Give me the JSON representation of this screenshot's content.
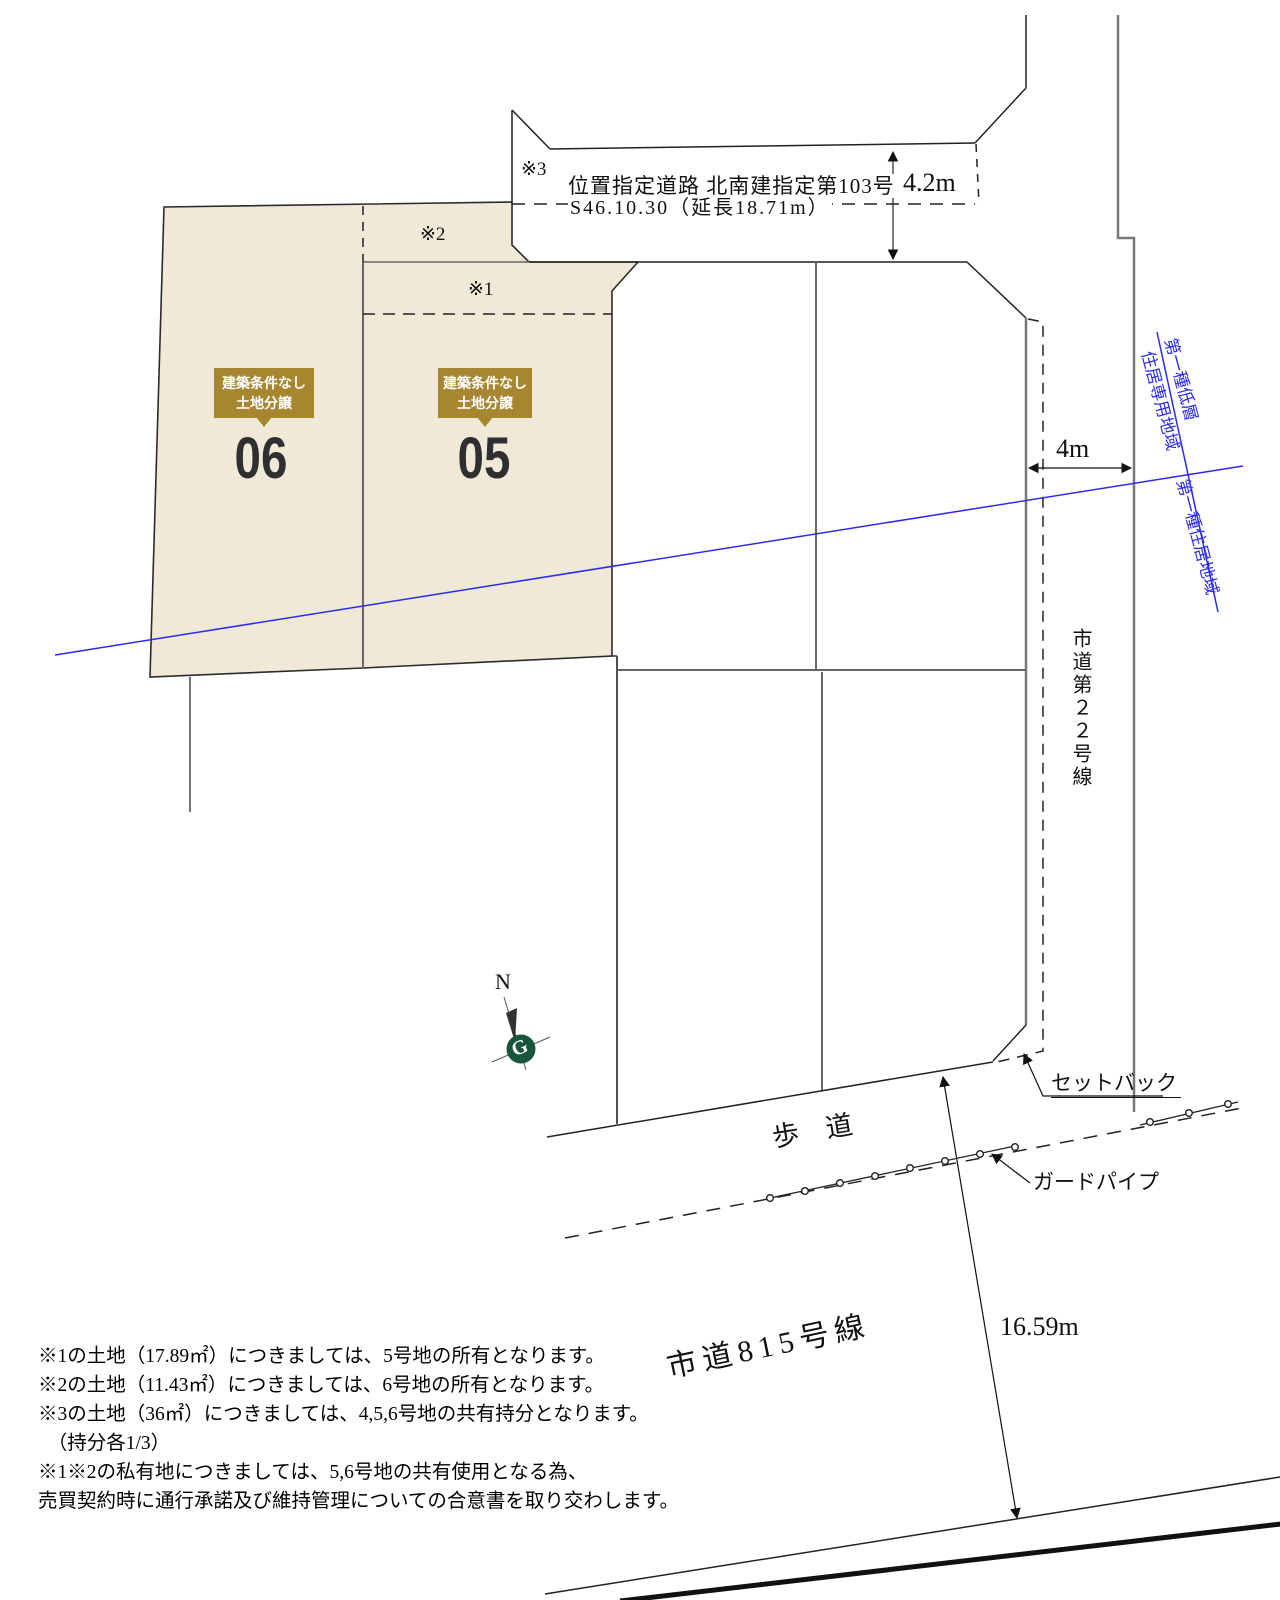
{
  "private_road": {
    "note3": "※3",
    "name": "位置指定道路 北南建指定第103号",
    "spec": "S46.10.30（延長18.71m）",
    "width_dim": "4.2m"
  },
  "lots": {
    "lot06": {
      "badge_line1": "建築条件なし",
      "badge_line2": "土地分譲",
      "number": "06"
    },
    "lot05": {
      "badge_line1": "建築条件なし",
      "badge_line2": "土地分譲",
      "number": "05"
    },
    "note1": "※1",
    "note2": "※2"
  },
  "city_road22": {
    "width_dim": "4m",
    "name_vertical": "市道第２２号線",
    "setback_label": "セットバック"
  },
  "zoning": {
    "upper_zone_line1": "第一種低層",
    "upper_zone_line2": "住居専用地域",
    "lower_zone": "第一種住居地域"
  },
  "south_area": {
    "sidewalk": "歩　道",
    "guard_pipe": "ガードパイプ",
    "frontage_dim": "16.59m",
    "road_name": "市道815号線"
  },
  "compass": {
    "north": "N",
    "logo": "G"
  },
  "notes": [
    "※1の土地（17.89㎡）につきましては、5号地の所有となります。",
    "※2の土地（11.43㎡）につきましては、6号地の所有となります。",
    "※3の土地（36㎡）につきましては、4,5,6号地の共有持分となります。",
    "　（持分各1/3）",
    "※1※2の私有地につきましては、5,6号地の共有使用となる為、",
    "売買契約時に通行承諾及び維持管理についての合意書を取り交わします。"
  ],
  "colors": {
    "lot_fill": "#f0e9d8",
    "badge_gold": "#a6862e",
    "zoning_blue": "#2b2bf0",
    "compass_green": "#17563a",
    "line_gray": "#666666",
    "line_black": "#1c1c1c"
  }
}
